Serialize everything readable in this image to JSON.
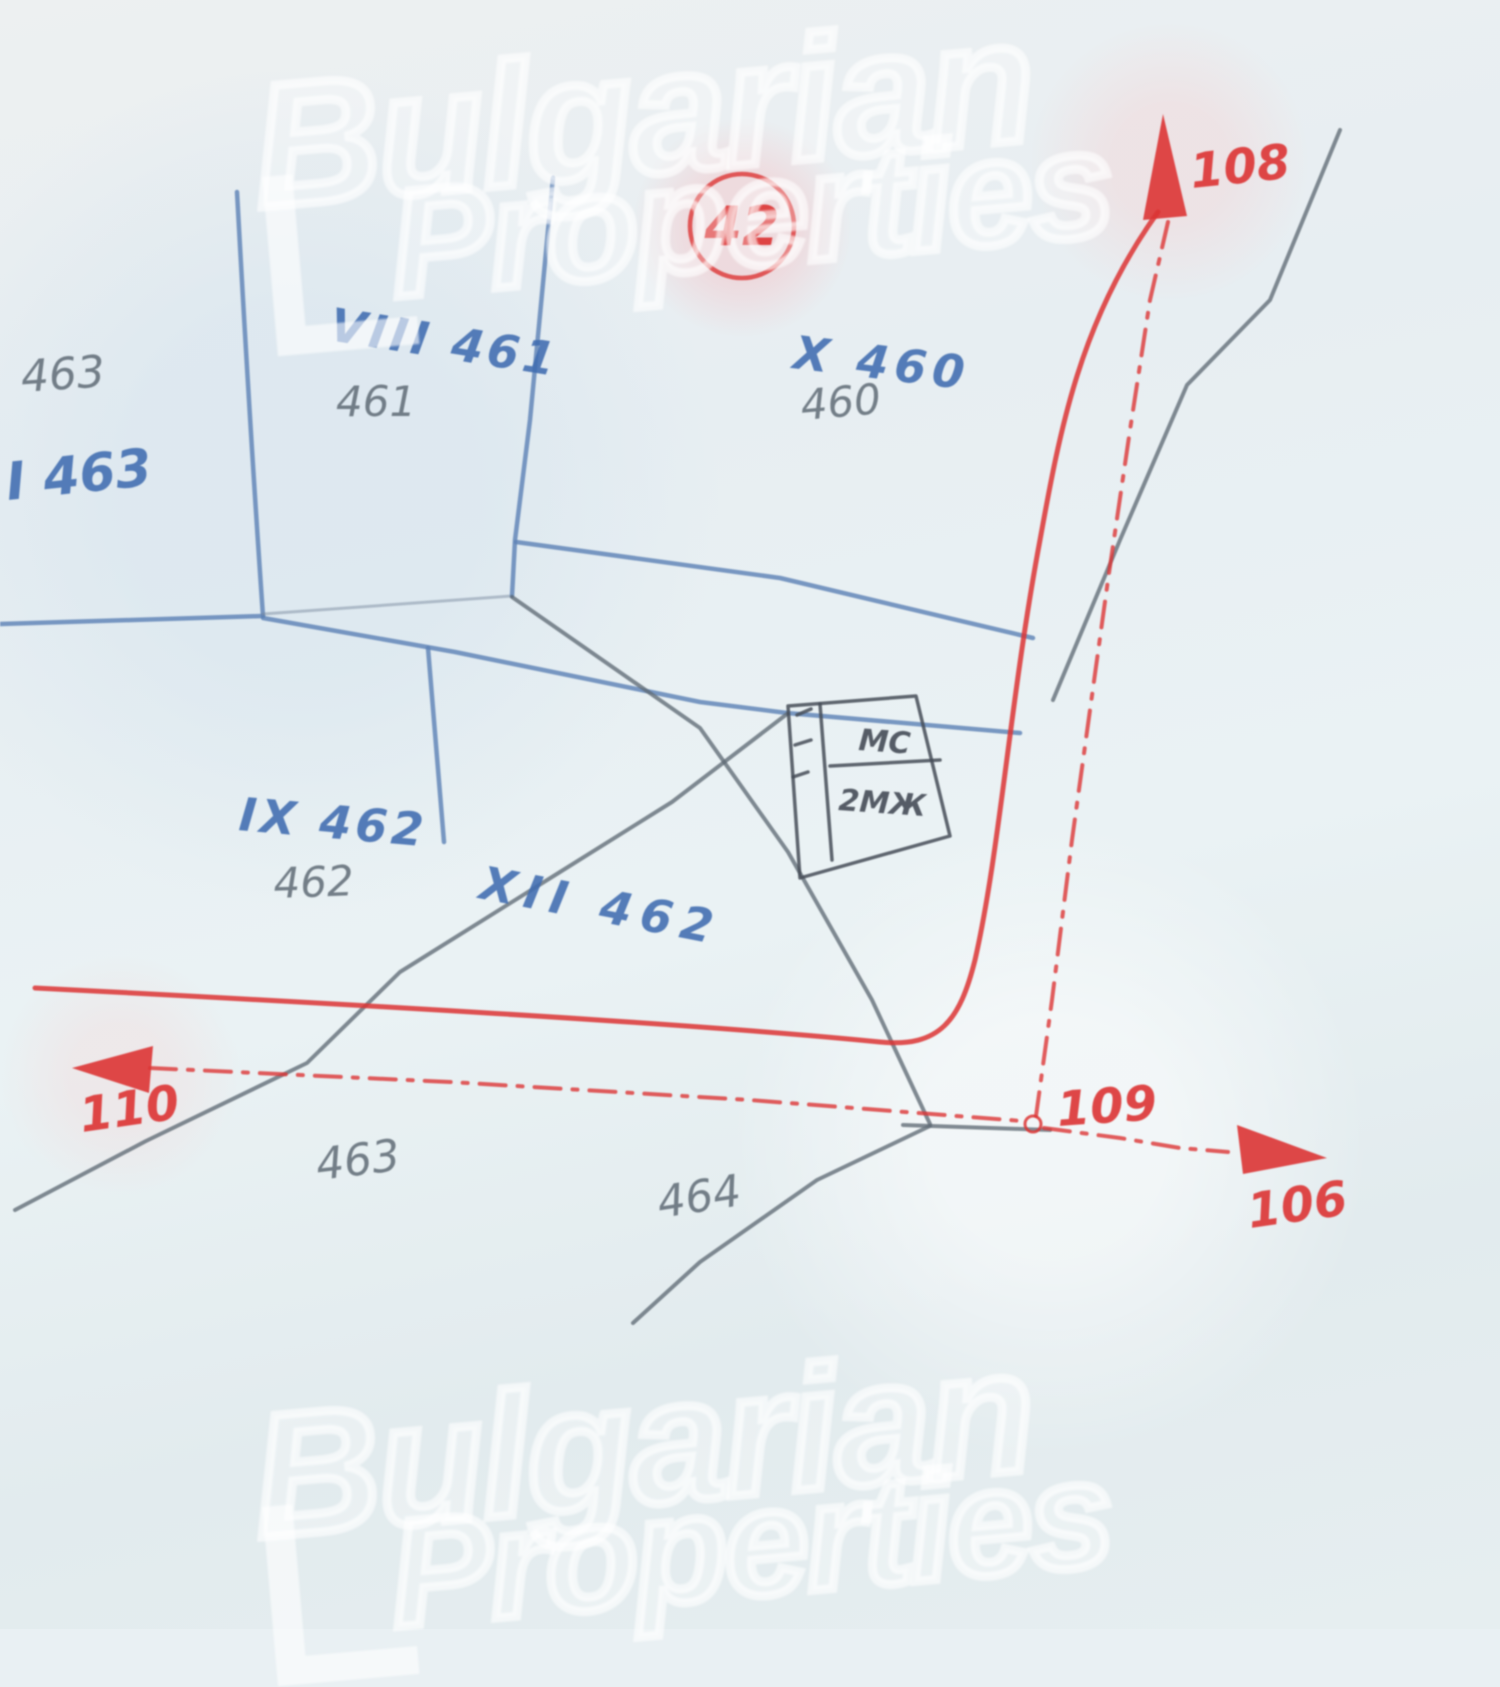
{
  "watermark": {
    "line1": "Bulgarian",
    "line2": "Properties"
  },
  "map": {
    "circled_plot_number": "42",
    "plots": {
      "top_left_pencil": "463",
      "top_left_blue": "I 463",
      "viii_blue": "VIII 461",
      "viii_pencil": "461",
      "x_blue": "X 460",
      "x_pencil": "460",
      "ix_blue": "IX 462",
      "ix_pencil": "462",
      "xii_blue": "XII 462",
      "bottom_463_pencil": "463",
      "bottom_464_pencil": "464"
    },
    "building": {
      "label_top": "МС",
      "label_bottom": "2МЖ"
    },
    "survey_points": {
      "north": "108",
      "corner": "109",
      "west": "110",
      "southeast": "106"
    },
    "colors": {
      "paper": "#e9f0f3",
      "boundary_blue": "#5e83b6",
      "pencil_gray": "#5f6a75",
      "ink_dark": "#454c57",
      "survey_red": "#dc3434",
      "label_blue": "#3f6cb0"
    }
  }
}
